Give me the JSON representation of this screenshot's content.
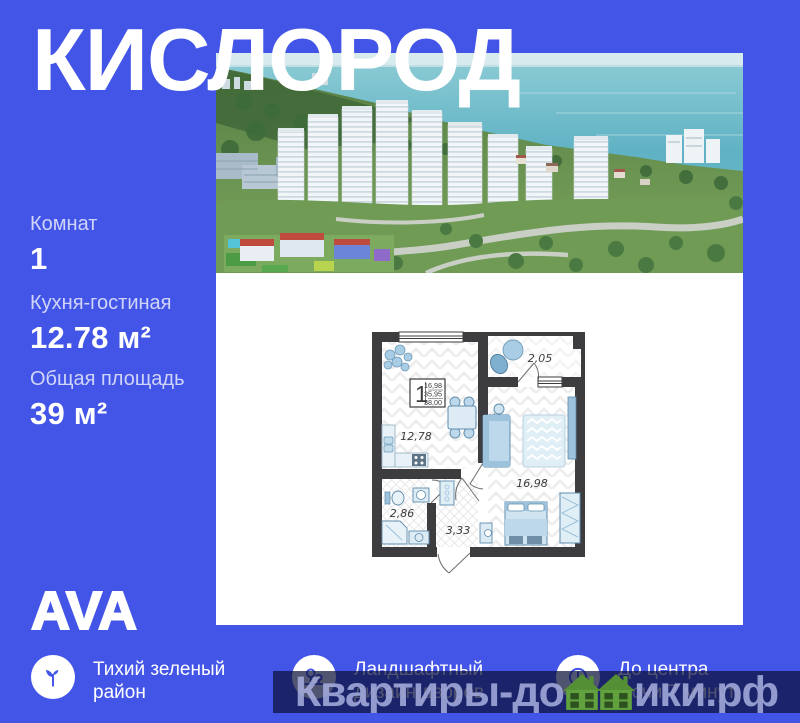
{
  "colors": {
    "background": "#4355e7",
    "wall": "#3d3d40",
    "furniture_light": "#cfe4f0",
    "furniture_mid": "#9cc2dc",
    "house_green": "#61a23e",
    "watermark_bar": "rgba(13,18,58,0.72)"
  },
  "title": "КИСЛОРОД",
  "stats": [
    {
      "label": "Комнат",
      "value": "1"
    },
    {
      "label": "Кухня-гостиная",
      "value": "12.78 м²"
    },
    {
      "label": "Общая площадь",
      "value": "39 м²"
    }
  ],
  "logo_text": "AVA",
  "features": [
    {
      "icon": "sprout-icon",
      "label": "Тихий зеленый район"
    },
    {
      "icon": "landscape-icon",
      "label": "Ландшафтный дизайн дворов"
    },
    {
      "icon": "clock-icon",
      "label": "До центра Сочи 7 минут"
    }
  ],
  "floor_plan": {
    "legend": {
      "room_count": "1",
      "areas": [
        "16,98",
        "35,95",
        "38,00"
      ]
    },
    "rooms": [
      {
        "name": "kitchen-living",
        "area": "12,78"
      },
      {
        "name": "balcony",
        "area": "2,05"
      },
      {
        "name": "living-bedroom",
        "area": "16,98"
      },
      {
        "name": "bathroom",
        "area": "2,86"
      },
      {
        "name": "hallway",
        "area": "3,33"
      }
    ]
  },
  "watermark": {
    "part1": "Квартиры-до",
    "part2": "ики.рф"
  }
}
